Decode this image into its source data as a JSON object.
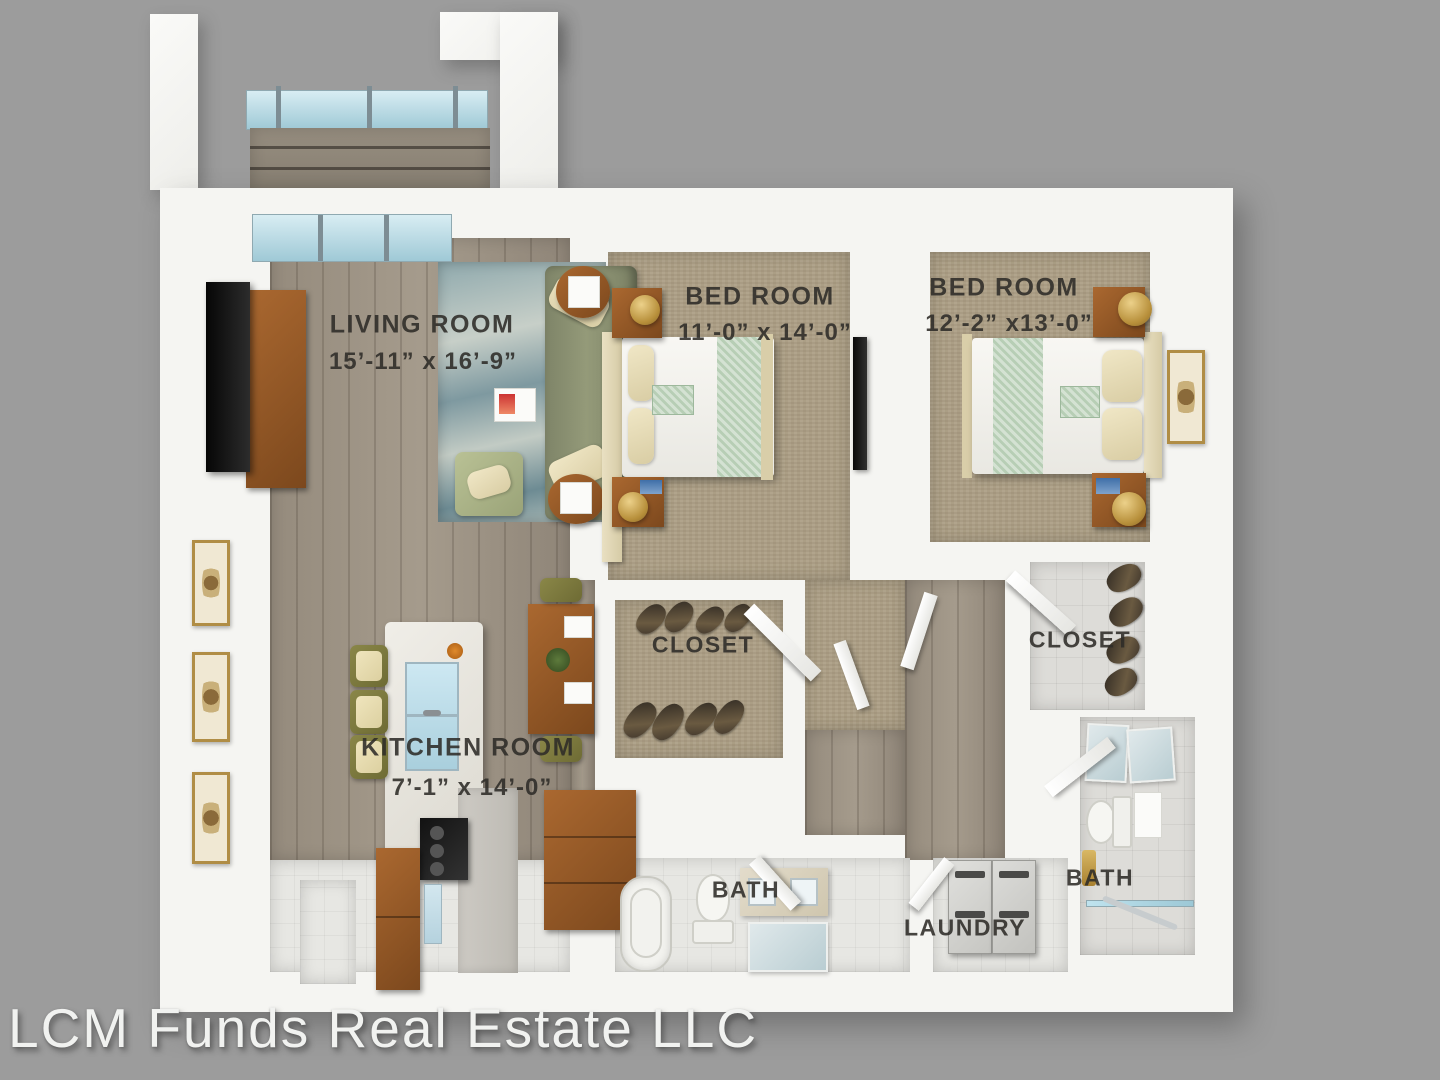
{
  "watermark": {
    "text": "LCM Funds Real Estate LLC"
  },
  "rooms": {
    "living": {
      "name": "LIVING ROOM",
      "dims": "15’-11” x 16’-9”"
    },
    "bedroom1": {
      "name": "BED ROOM",
      "dims": "11’-0” x 14’-0”"
    },
    "bedroom2": {
      "name": "BED ROOM",
      "dims": "12’-2” x13’-0”"
    },
    "closet1": {
      "name": "CLOSET"
    },
    "closet2": {
      "name": "CLOSET"
    },
    "kitchen": {
      "name": "KITCHEN ROOM",
      "dims": "7’-1” x 14’-0”"
    },
    "bath1": {
      "name": "BATH"
    },
    "bath2": {
      "name": "BATH"
    },
    "laundry": {
      "name": "LAUNDRY"
    }
  },
  "colors": {
    "background": "#9c9c9c",
    "wall": "#f5f5f2",
    "wood_floor": "#9a9083",
    "carpet": "#ab9e85",
    "rug_accent": "#7e99a0",
    "sofa_green": "#8a9072",
    "wood_furniture": "#9a5f2a",
    "bed_runner": "#b7ceb5",
    "glass": "#a9d2de",
    "label_text": "#2e2c28"
  }
}
